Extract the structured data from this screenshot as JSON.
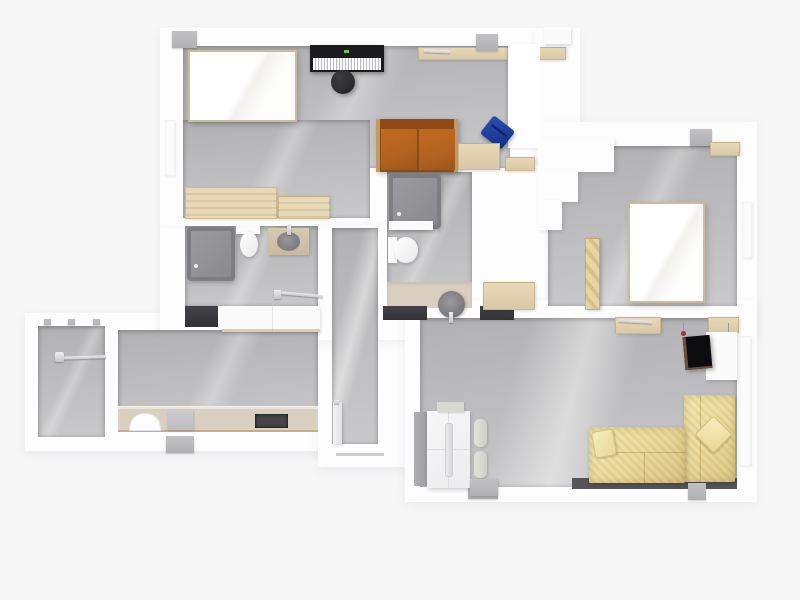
{
  "scene": {
    "type": "floor-plan-3d-top-view",
    "description": "Rendered top-down apartment floor plan, no visible text labels"
  },
  "palette": {
    "background": "#f7f7f8",
    "wall": "#fdfdfe",
    "floor_dark": "#b1b1b3",
    "floor_light": "#c9c9cb",
    "wood": "#e8d9b6",
    "wood_dark": "#d9c8a5",
    "sofa_orange": "#b2631f",
    "sofa_orange_dark": "#8f4a14",
    "armchair_blue": "#1e3d9b",
    "yellow_light": "#f2e6ac",
    "yellow_dark": "#d9c27e",
    "chrome": "#c6c6c8",
    "tab": "#b0b0b2",
    "mat": "#323236",
    "tv_black": "#0c0c0e",
    "tv_frame_brown": "#6e4c38",
    "red_hook": "#a8332c",
    "beige_floor": "#d9cec0",
    "counter_beige": "#d8cfc1",
    "counter_edge": "#c4ae8a",
    "shower_frame": "#7e7e82",
    "shower_light": "#9b9b9f",
    "shower_dark": "#8a8a8e",
    "piano_black": "#1a1a1c",
    "piano_led_green": "#7ac142",
    "cooktop_dark": "#46464a",
    "sofa_shadow_strip": "#55555a"
  },
  "rooms": [
    {
      "name": "bedroom-music-room"
    },
    {
      "name": "bathroom-main"
    },
    {
      "name": "bathroom-small"
    },
    {
      "name": "hallway"
    },
    {
      "name": "balcony"
    },
    {
      "name": "kitchen-dining"
    },
    {
      "name": "bedroom-2"
    },
    {
      "name": "living-room"
    },
    {
      "name": "entry-nook"
    }
  ],
  "furniture": [
    "double-bed",
    "piano",
    "piano-stool",
    "dresser",
    "loveseat-orange",
    "armchair-blue",
    "side-table",
    "shower",
    "toilet",
    "washbasin",
    "vanity",
    "towel-rail",
    "bath-mat",
    "white-counter",
    "laundry-rail",
    "kitchen-counter",
    "kitchen-sink",
    "cooktop",
    "appliance",
    "bed-2",
    "wardrobe-strip",
    "closet-steps",
    "wall-desk",
    "wall-hook",
    "tv",
    "sofa-yellow-l-shape",
    "wardrobe-white",
    "towel-rolls",
    "vent-tab",
    "window-marker",
    "door-leaf"
  ]
}
